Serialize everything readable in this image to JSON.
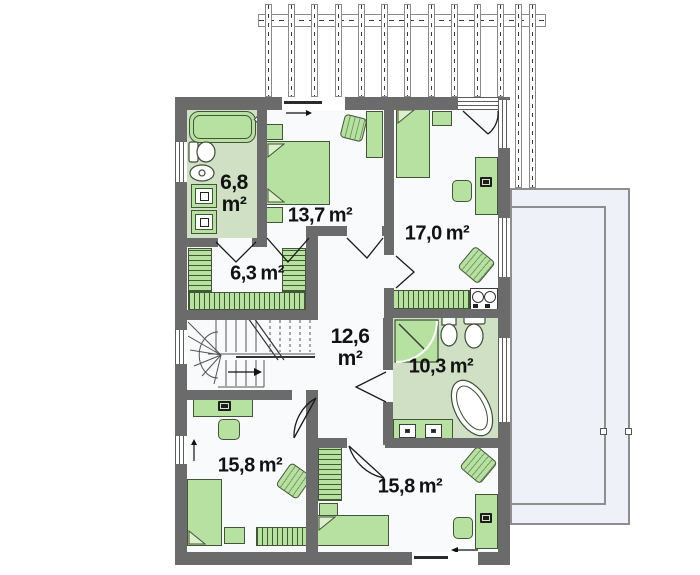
{
  "plan": {
    "kind": "house-upper-floor-plan"
  },
  "rooms": [
    {
      "key": "bathroom-small",
      "value": "6,8",
      "unit": "m²",
      "stacked": true
    },
    {
      "key": "bedroom-top",
      "value": "13,7",
      "unit": "m²"
    },
    {
      "key": "bedroom-right",
      "value": "17,0",
      "unit": "m²"
    },
    {
      "key": "walkin-closet",
      "value": "6,3",
      "unit": "m²"
    },
    {
      "key": "hall",
      "value": "12,6",
      "unit": "m²",
      "stacked": true
    },
    {
      "key": "bathroom-large",
      "value": "10,3",
      "unit": "m²"
    },
    {
      "key": "bedroom-bottom-left",
      "value": "15,8",
      "unit": "m²"
    },
    {
      "key": "bedroom-bottom-right",
      "value": "15,8",
      "unit": "m²"
    }
  ],
  "colors": {
    "wall": "#6b6b6b",
    "floor": "#f8fafc",
    "bathroom_floor": "#cfe0c4",
    "furniture": "#b7e1a1",
    "furniture_outline": "#44543a",
    "terrace": "#eef2f8",
    "outline": "#1c1c1c"
  }
}
